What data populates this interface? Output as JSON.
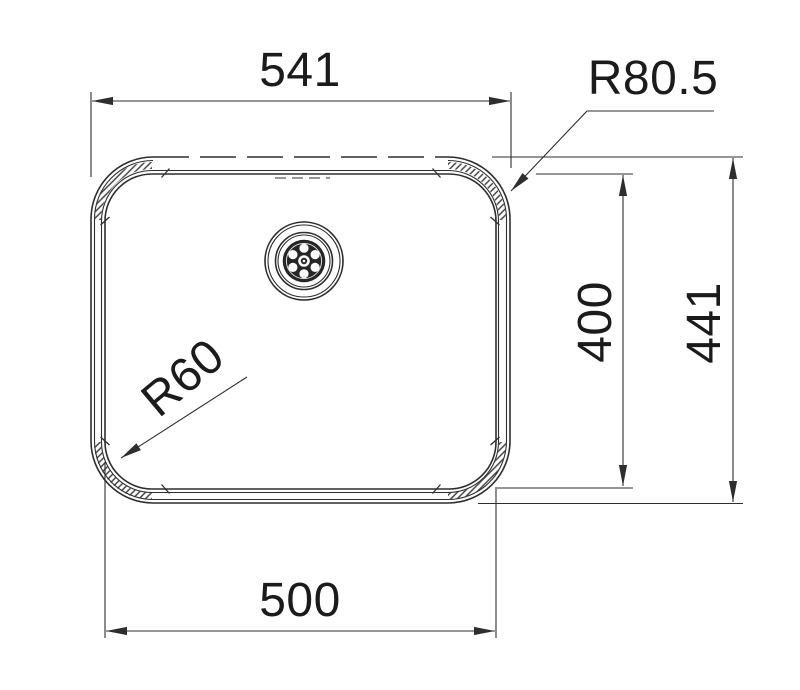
{
  "drawing": {
    "subject": "sink-bowl-top-view-technical-drawing",
    "colors": {
      "background": "#ffffff",
      "line": "#2e2e2e",
      "text": "#1b1b1b",
      "hatch": "#3a3a3a",
      "strainer": "#262626"
    },
    "dimensions": {
      "top_width": "541",
      "outer_corner_radius": "R80.5",
      "inner_height": "400",
      "outer_height": "441",
      "inner_corner_radius": "R60",
      "bottom_width": "500"
    }
  }
}
